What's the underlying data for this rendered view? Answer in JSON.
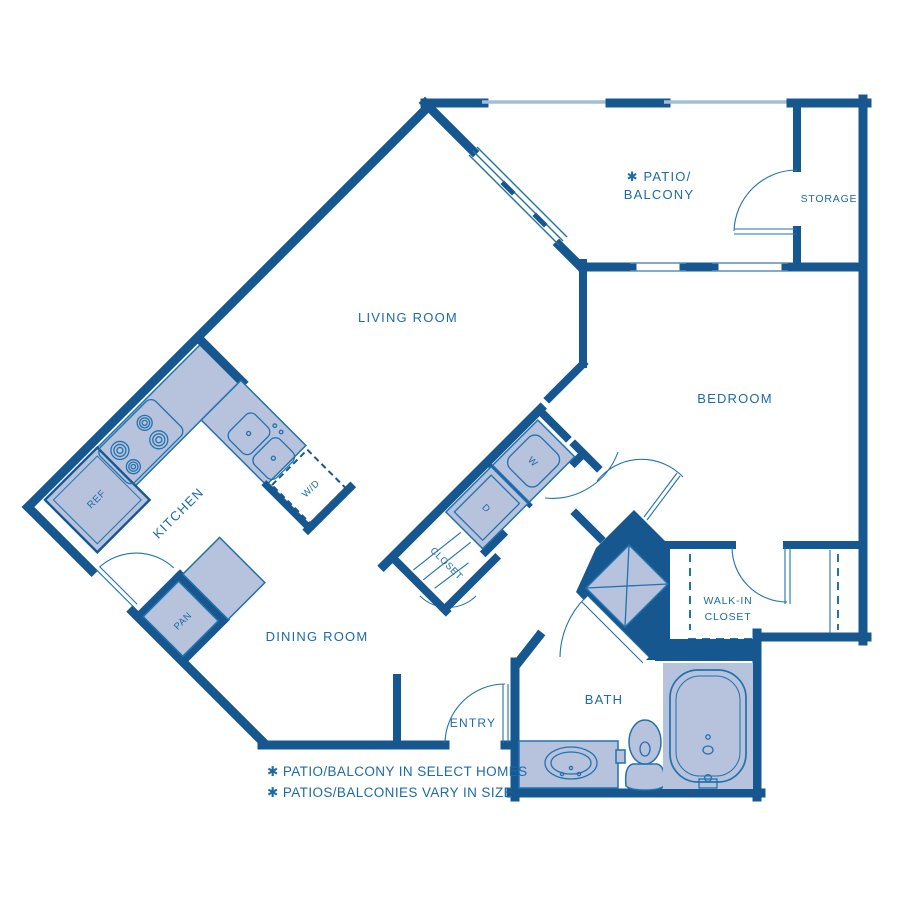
{
  "title": "One-bedroom apartment floor plan",
  "colors": {
    "wall": "#17578F",
    "fill": "#B7C2DC",
    "line": "#2272AE",
    "text": "#1C6BA6",
    "rail": "#A3BED9",
    "background": "#ffffff"
  },
  "labels": {
    "patio_line1": "✱ PATIO/",
    "patio_line2": "BALCONY",
    "storage": "STORAGE",
    "living_room": "LIVING ROOM",
    "bedroom": "BEDROOM",
    "kitchen": "KITCHEN",
    "dining_room": "DINING ROOM",
    "ref": "REF",
    "wd": "W/D",
    "pan": "PAN",
    "washer": "W",
    "dryer": "D",
    "closet": "CLOSET",
    "walk_in_line1": "WALK-IN",
    "walk_in_line2": "CLOSET",
    "bath": "BATH",
    "entry": "ENTRY"
  },
  "footnotes": [
    "✱ PATIO/BALCONY IN SELECT HOMES",
    "✱ PATIOS/BALCONIES VARY IN SIZE"
  ]
}
